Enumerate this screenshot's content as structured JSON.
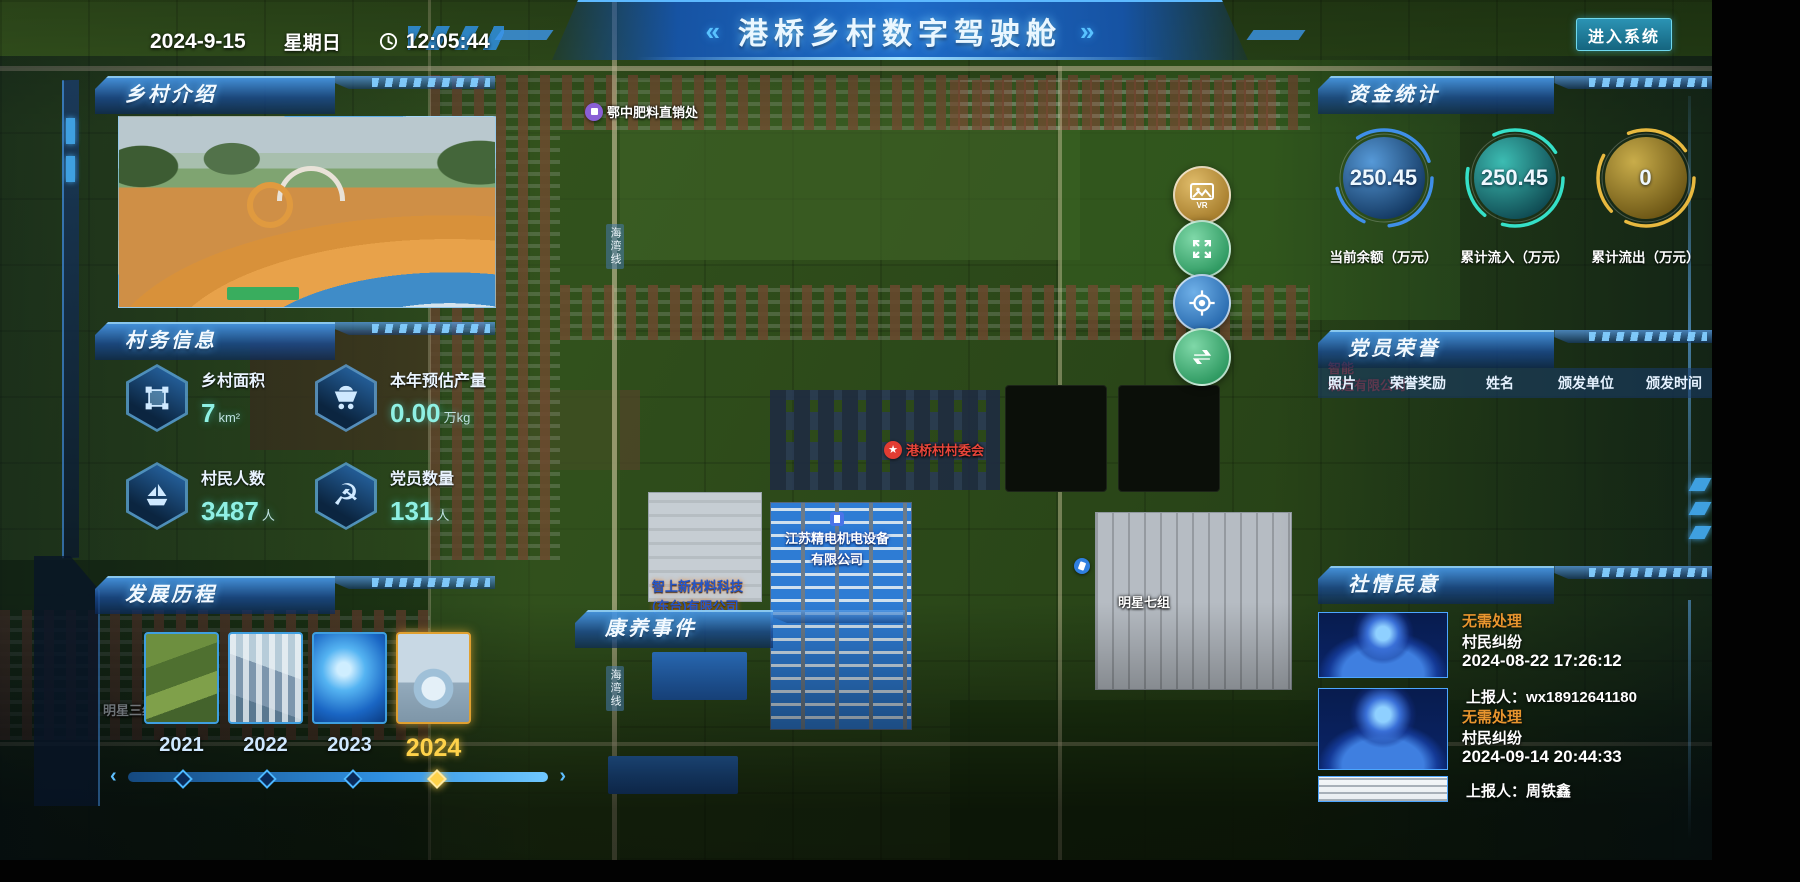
{
  "header": {
    "date": "2024-9-15",
    "weekday": "星期日",
    "time": "12:05:44",
    "deco_left": "«",
    "deco_right": "»",
    "title": "港桥乡村数字驾驶舱",
    "enter_button": "进入系统"
  },
  "village_intro": {
    "title": "乡村介绍"
  },
  "village_info": {
    "title": "村务信息",
    "stats": [
      {
        "icon": "area-icon",
        "label": "乡村面积",
        "value": "7",
        "unit": "km²"
      },
      {
        "icon": "cart-icon",
        "label": "本年预估产量",
        "value": "0.00",
        "unit": "万kg"
      },
      {
        "icon": "boat-icon",
        "label": "村民人数",
        "value": "3487",
        "unit": "人"
      },
      {
        "icon": "party-icon",
        "label": "党员数量",
        "value": "131",
        "unit": "人"
      }
    ]
  },
  "development": {
    "title": "发展历程",
    "years": [
      "2021",
      "2022",
      "2023",
      "2024"
    ],
    "active_year": "2024",
    "slider_prev": "‹",
    "slider_next": "›"
  },
  "funds": {
    "title": "资金统计",
    "gauges": [
      {
        "value": "250.45",
        "label": "当前余额（万元）",
        "color": "#3f8fe8"
      },
      {
        "value": "250.45",
        "label": "累计流入（万元）",
        "color": "#35e0c8"
      },
      {
        "value": "0",
        "label": "累计流出（万元）",
        "color": "#e8b93f"
      }
    ]
  },
  "party_honor": {
    "title": "党员荣誉",
    "columns": [
      "照片",
      "荣誉奖励",
      "姓名",
      "颁发单位",
      "颁发时间"
    ]
  },
  "sentiment": {
    "title": "社情民意",
    "items": [
      {
        "status": "无需处理",
        "category": "村民纠纷",
        "time": "2024-08-22 17:26:12",
        "reporter": "上报人：wx18912641180"
      },
      {
        "status": "无需处理",
        "category": "村民纠纷",
        "time": "2024-09-14 20:44:33",
        "reporter": "上报人：周铁鑫"
      }
    ]
  },
  "health_events": {
    "title": "康养事件"
  },
  "map": {
    "vr_label": "VR",
    "poi": {
      "fertilizer": "鄂中肥料直销处",
      "committee": "港桥村村委会",
      "company1_line1": "江苏精电机电设备",
      "company1_line2": "有限公司",
      "company2_line1": "智上新材料科技",
      "company2_line2": "(东台)有限公司",
      "group7": "明星七组",
      "group3": "明星三组",
      "road": "海湾线",
      "red_line1": "智能",
      "red_line2": "制造有限公司"
    }
  }
}
